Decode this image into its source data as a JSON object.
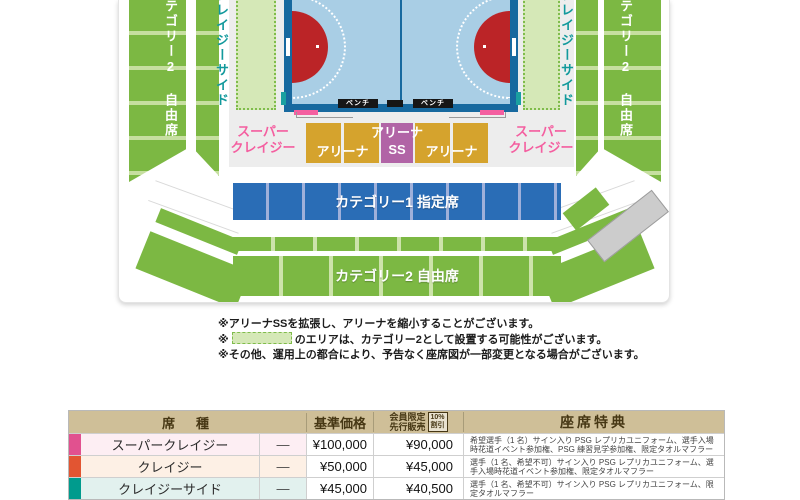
{
  "map": {
    "stand_left_label": "カテゴリー2 自由席",
    "stand_right_label": "カテゴリー2 自由席",
    "crazy_side_left": "クレイジーサイド",
    "crazy_side_right": "クレイジーサイド",
    "super_crazy_left": {
      "line1": "スーパー",
      "line2": "クレイジー"
    },
    "super_crazy_right": {
      "line1": "スーパー",
      "line2": "クレイジー"
    },
    "arena_left": "アリーナ",
    "arena_right": "アリーナ",
    "arena_ss": {
      "line1": "アリーナ",
      "line2": "SS"
    },
    "bench_left": "ベンチ",
    "bench_right": "ベンチ",
    "cat1_label": "カテゴリー1 指定席",
    "cat2_label": "カテゴリー2 自由席",
    "colors": {
      "stand_green": "#7cb843",
      "stand_light_green": "#c6dfa0",
      "option_area_green": "#d5e8b7",
      "court_border_blue": "#17699f",
      "court_floor_blue": "#a9cee5",
      "goal_area_red": "#bb2427",
      "arena_gold": "#d5a32d",
      "arena_ss_purple": "#b164a6",
      "super_crazy_pink": "#f45fa0",
      "cat1_blue": "#2a6db6",
      "crazy_side_teal": "#12999c",
      "closed_gray": "#cccccc"
    }
  },
  "notes": {
    "line1": "※アリーナSSを拡張し、アリーナを縮小することがございます。",
    "line2_prefix": "※",
    "line2_suffix": "のエリアは、カテゴリー2として設置する可能性がございます。",
    "line3": "※その他、運用上の都合により、予告なく座席図が一部変更となる場合がございます。"
  },
  "table": {
    "headers": {
      "seat_type": "席　種",
      "base_price": "基準価格",
      "member_line1": "会員限定",
      "member_line2": "先行販売",
      "discount_line1": "10%",
      "discount_line2": "割引",
      "benefits": "座席特典"
    },
    "rows": [
      {
        "color": "#e1518f",
        "tint": "#fdeef3",
        "name": "スーパークレイジー",
        "dash": "—",
        "base": "¥100,000",
        "member": "¥90,000",
        "benefit": "希望選手（1 名）サイン入り PSG レプリカユニフォーム、選手入場時花道イベント参加権、PSG 練習見学参加権、限定タオルマフラー"
      },
      {
        "color": "#e25532",
        "tint": "#fdf0e5",
        "name": "クレイジー",
        "dash": "—",
        "base": "¥50,000",
        "member": "¥45,000",
        "benefit": "選手（1 名、希望不可）サイン入り PSG レプリカユニフォーム、選手入場時花道イベント参加権、限定タオルマフラー"
      },
      {
        "color": "#009b8d",
        "tint": "#e2f1ee",
        "name": "クレイジーサイド",
        "dash": "—",
        "base": "¥45,000",
        "member": "¥40,500",
        "benefit": "選手（1 名、希望不可）サイン入り PSG レプリカユニフォーム、限定タオルマフラー"
      }
    ]
  }
}
